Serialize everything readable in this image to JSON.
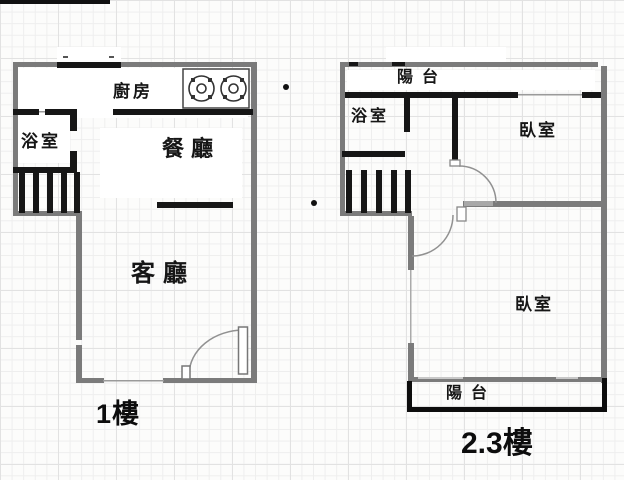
{
  "document": {
    "type": "floor-plan",
    "floors_shown": 2
  },
  "colors": {
    "outer_wall": "#7b7b7b",
    "inner_wall": "#161616",
    "door_stroke": "#919191",
    "window_line": "#9a9a9a",
    "grid_minor": "#eeeeee",
    "grid_major": "#e2e2e2"
  },
  "floor1": {
    "label": "1樓",
    "rooms": {
      "kitchen": "廚房",
      "bathroom": "浴室",
      "dining": "餐廳",
      "living": "客廳"
    },
    "features": [
      "stove-2-burner",
      "stairs",
      "entry-door",
      "window-bottom"
    ]
  },
  "floor23": {
    "label": "2.3樓",
    "rooms": {
      "balcony_top": "陽台",
      "bathroom": "浴室",
      "bedroom_upper": "臥室",
      "bedroom_lower": "臥室",
      "balcony_bottom": "陽台"
    },
    "features": [
      "stairs",
      "two-doors",
      "window-top",
      "window-left"
    ]
  }
}
